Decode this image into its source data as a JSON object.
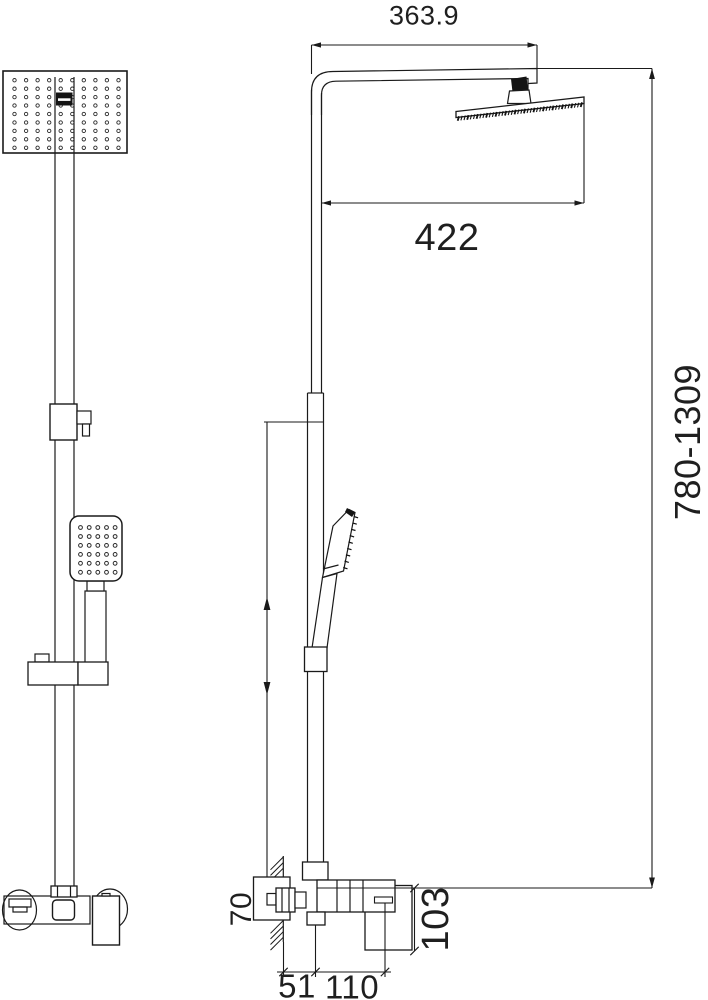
{
  "dimensions": {
    "arm_length": "363.9",
    "head_reach": "422",
    "height_range": "780-1309",
    "wall_plate_height": "70",
    "mixer_height": "103",
    "wall_offset": "51",
    "handle_offset": "110"
  },
  "views": {
    "front_view": {
      "overhead_dot_grid": {
        "cols": 10,
        "rows": 9
      },
      "hand_dot_grid": {
        "cols": 5,
        "rows": 6
      }
    },
    "side_view": {
      "overhead_nozzle_ticks": 40,
      "hand_nozzle_ticks": 9
    }
  },
  "colors": {
    "line": "#1a1a1a",
    "dark_fill": "#141414",
    "background": "#ffffff"
  }
}
